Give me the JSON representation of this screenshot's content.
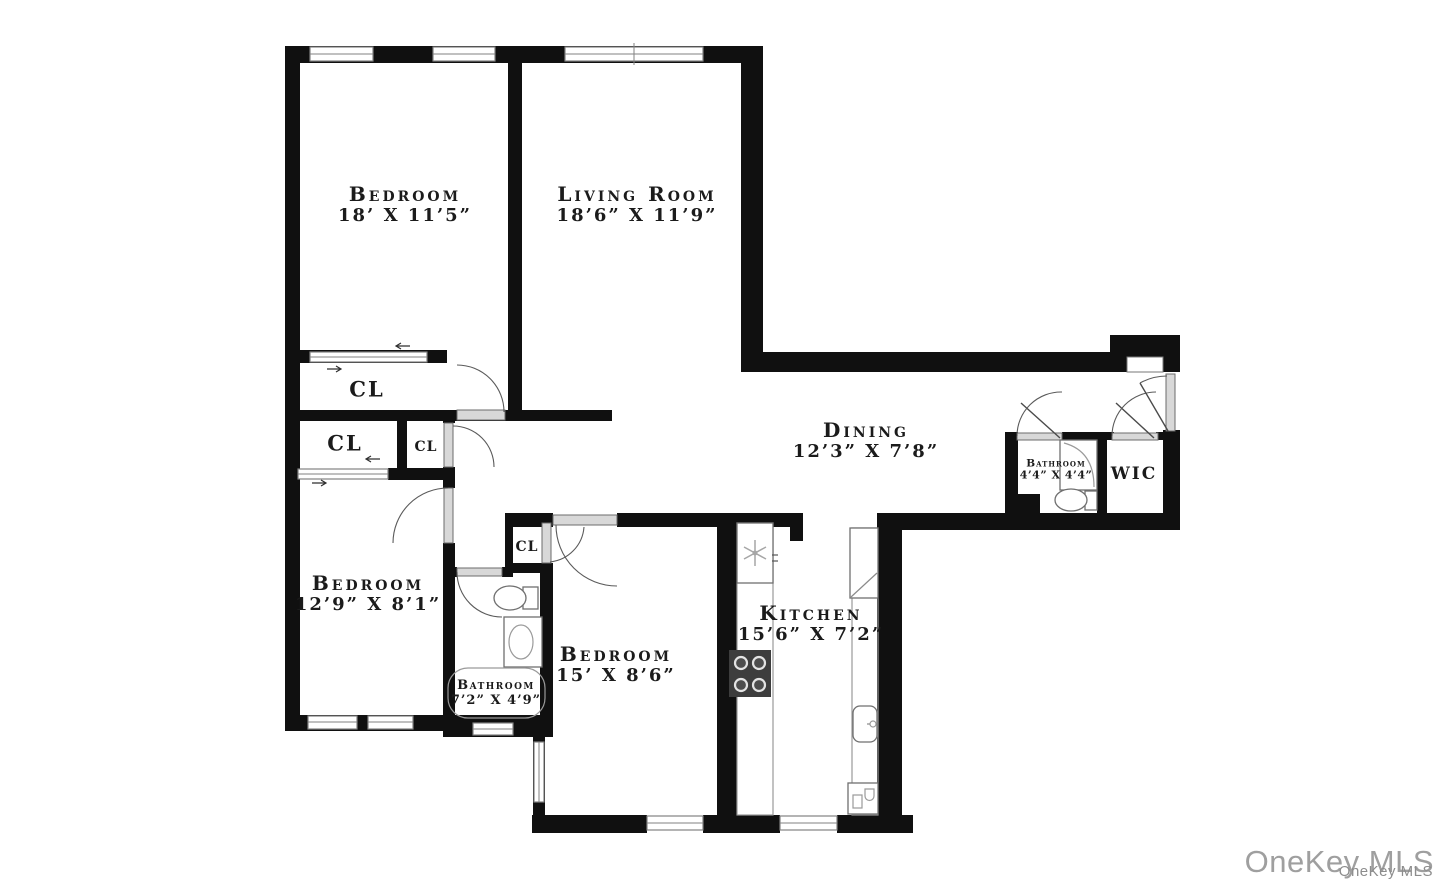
{
  "colors": {
    "wall": "#101010",
    "window": "#828282",
    "fixture": "#6f6f6f",
    "text": "#1b1b1b",
    "watermark": "#9f9f9f",
    "background": "#ffffff",
    "stove": "#3d3d3d"
  },
  "rooms": {
    "bedroom_top": {
      "name": "Bedroom",
      "dims": "18’ X 11’5”"
    },
    "living_room": {
      "name": "Living Room",
      "dims": "18’6” X 11’9”"
    },
    "dining": {
      "name": "Dining",
      "dims": "12’3” X 7’8”"
    },
    "kitchen": {
      "name": "Kitchen",
      "dims": "15’6” X 7’2”"
    },
    "bedroom_middle": {
      "name": "Bedroom",
      "dims": "15’ X 8’6”"
    },
    "bedroom_left": {
      "name": "Bedroom",
      "dims": "12’9” X 8’1”"
    },
    "bathroom_main": {
      "name": "Bathroom",
      "dims": "7’2” X 4’9”"
    },
    "bathroom_ensuite": {
      "name": "Bathroom",
      "dims": "4’4” X 4’4”"
    },
    "wic": {
      "name": "WIC"
    }
  },
  "closets": {
    "cl1": "CL",
    "cl2": "CL",
    "cl3": "CL",
    "cl4": "CL"
  },
  "fixtures": {
    "bathroom_main": [
      "toilet-icon",
      "sink-icon",
      "bathtub-icon"
    ],
    "bathroom_ensuite": [
      "shower-icon",
      "toilet-icon"
    ],
    "kitchen": [
      "fan-icon",
      "stove-icon",
      "refrigerator-icon",
      "kitchen-sink-icon",
      "dishwasher-icon"
    ]
  },
  "watermark": {
    "primary": "OneKey MLS",
    "secondary": "OneKey MLS"
  }
}
